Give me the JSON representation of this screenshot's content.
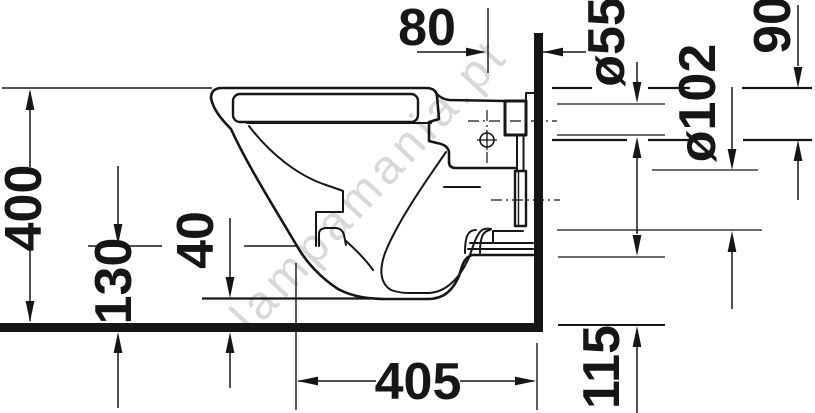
{
  "drawing": {
    "title": "wall-hung-toilet-side-elevation",
    "dimensions": {
      "fixing_offset_from_wall": "80",
      "supply_pipe_diameter": "ø55",
      "supply_drop_from_top": "90",
      "outlet_pipe_diameter": "ø102",
      "overall_height": "400",
      "bowl_underside_front_height": "130",
      "trap_clearance_height": "40",
      "overall_depth": "405",
      "outlet_height_above_floor": "115"
    },
    "watermark": "lampamania.pt",
    "colors": {
      "line": "#161616",
      "watermark": "#b8b8b8",
      "background": "#ffffff"
    }
  }
}
